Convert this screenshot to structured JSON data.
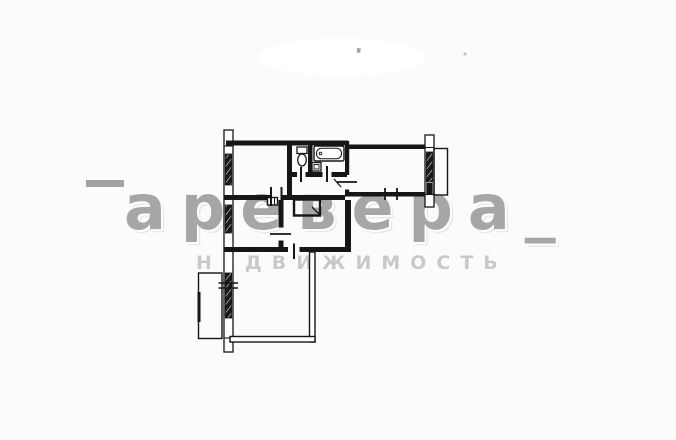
{
  "canvas": {
    "width": 676,
    "height": 440,
    "background": "#fbfbf9"
  },
  "watermark": {
    "brand": "аревера_",
    "tagline": "НЕДВИЖИМОСТЬ",
    "brand_color": "#9f9f9f",
    "tagline_color": "#c9c9c9"
  },
  "plan": {
    "line_color": "#161616"
  }
}
